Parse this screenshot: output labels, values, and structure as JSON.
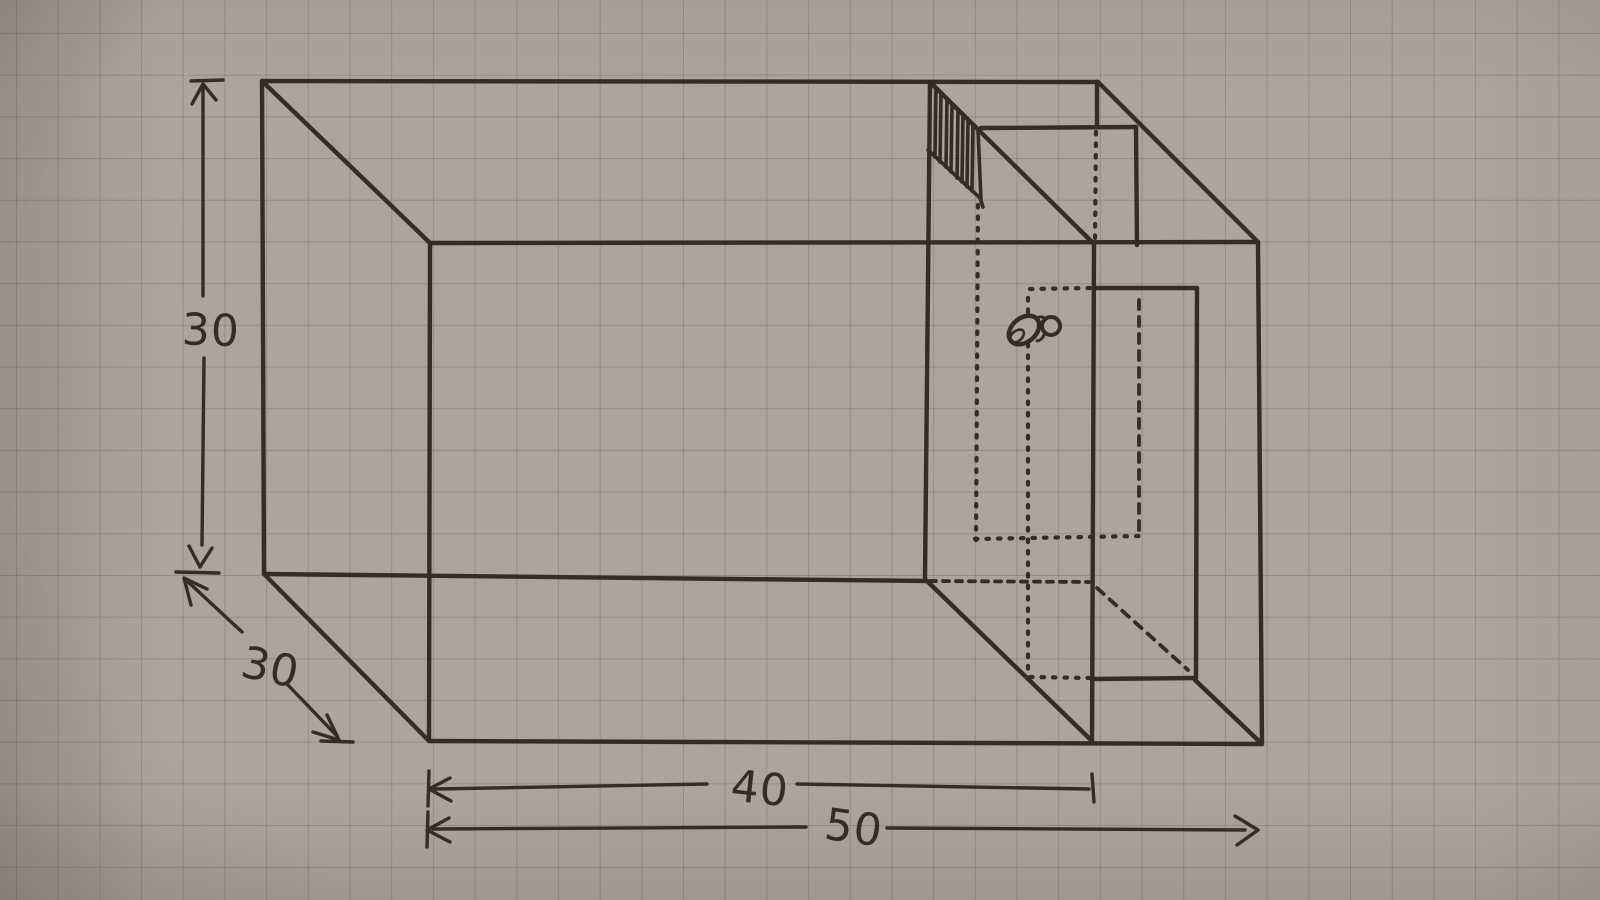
{
  "diagram": {
    "title": "Hand-drawn oblique sketch of a rectangular tank with internal partition compartment, slotted grate and tap mark, on squared paper",
    "labels": {
      "height": "30",
      "depth": "30",
      "partition_length": "40",
      "total_length": "50"
    },
    "colors": {
      "paper": "#aea49d",
      "ink": "#332c27"
    },
    "icons": [
      "grate-hatch-icon",
      "tap-icon"
    ]
  }
}
